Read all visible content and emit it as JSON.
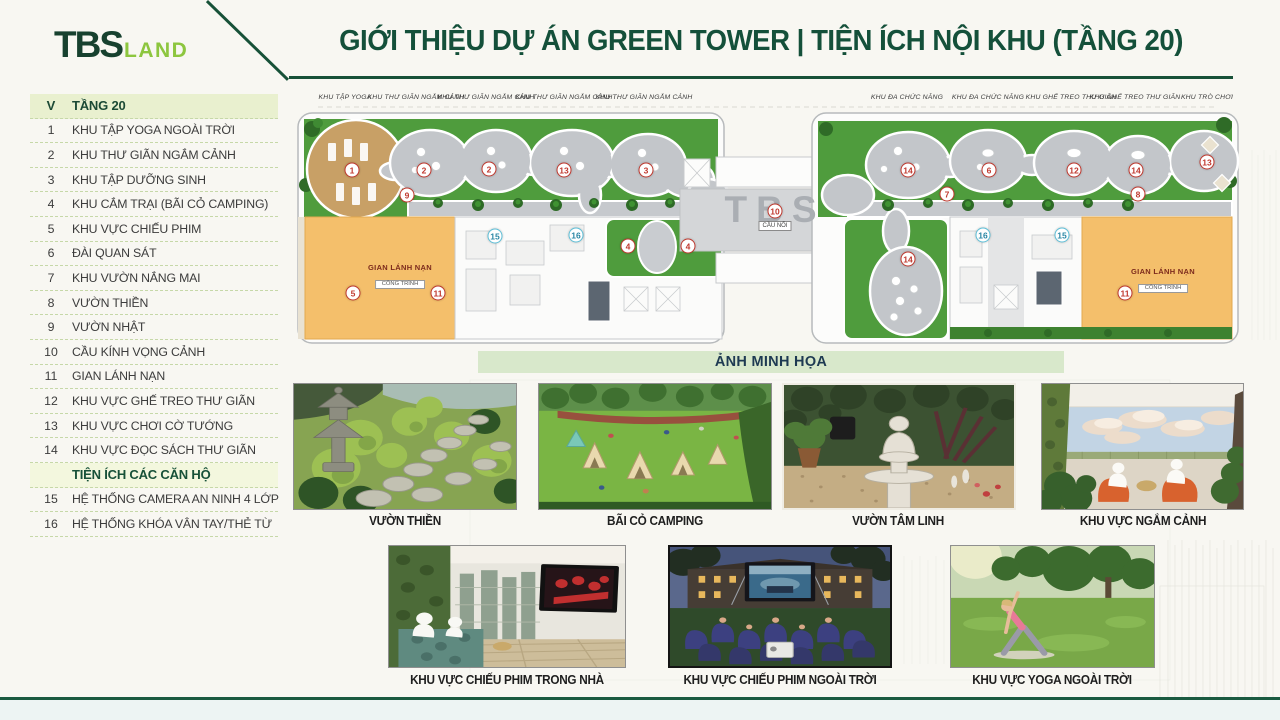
{
  "logo": {
    "tbs": "TBS",
    "land": "LAND"
  },
  "header": {
    "title": "GIỚI THIỆU DỰ ÁN GREEN TOWER | TIỆN ÍCH NỘI KHU (TẦNG 20)"
  },
  "legend": {
    "header": {
      "no": "V",
      "label": "TẦNG 20"
    },
    "rows": [
      {
        "no": "1",
        "label": "KHU TẬP YOGA NGOÀI TRỜI"
      },
      {
        "no": "2",
        "label": "KHU THƯ GIÃN NGẮM CẢNH"
      },
      {
        "no": "3",
        "label": "KHU TẬP DƯỠNG SINH"
      },
      {
        "no": "4",
        "label": "KHU CẮM TRẠI (BÃI CỎ CAMPING)"
      },
      {
        "no": "5",
        "label": "KHU VỰC CHIẾU PHIM"
      },
      {
        "no": "6",
        "label": "ĐÀI QUAN SÁT"
      },
      {
        "no": "7",
        "label": "KHU VƯỜN NẮNG MAI"
      },
      {
        "no": "8",
        "label": "VƯỜN THIỀN"
      },
      {
        "no": "9",
        "label": "VƯỜN NHẬT"
      },
      {
        "no": "10",
        "label": "CẦU KÍNH VỌNG CẢNH"
      },
      {
        "no": "11",
        "label": "GIAN LÁNH NẠN"
      },
      {
        "no": "12",
        "label": "KHU VỰC GHẾ TREO THƯ GIÃN"
      },
      {
        "no": "13",
        "label": "KHU VỰC CHƠI CỜ TƯỚNG"
      },
      {
        "no": "14",
        "label": "KHU VỰC ĐỌC SÁCH THƯ GIÃN"
      }
    ],
    "subheader": "TIỆN ÍCH CÁC CĂN HỘ",
    "rows2": [
      {
        "no": "15",
        "label": "HỆ THỐNG CAMERA AN NINH 4 LỚP"
      },
      {
        "no": "16",
        "label": "HỆ THỐNG KHÓA VÂN TAY/THẺ TỪ"
      }
    ]
  },
  "floorplan": {
    "bridge_text": "TBS",
    "bridge_label": "CẦU NỐI",
    "shelter": {
      "line1": "GIAN LÁNH NẠN",
      "line2": "CÔNG TRÌNH"
    },
    "zone_labels": [
      {
        "label": "KHU TẬP YOGA",
        "x": 57
      },
      {
        "label": "KHU THƯ GIÃN NGẮM CẢNH",
        "x": 128
      },
      {
        "label": "KHU THƯ GIÃN NGẮM CẢNH",
        "x": 198
      },
      {
        "label": "KHU THƯ GIÃN NGẮM CẢNH",
        "x": 276
      },
      {
        "label": "KHU THƯ GIÃN NGẮM CẢNH",
        "x": 356
      },
      {
        "label": "KHU ĐA CHỨC NĂNG",
        "x": 619
      },
      {
        "label": "KHU ĐA CHỨC NĂNG",
        "x": 700
      },
      {
        "label": "KHU GHẾ TREO THƯ GIÃN",
        "x": 783
      },
      {
        "label": "KHU GHẾ TREO THƯ GIÃN",
        "x": 847
      },
      {
        "label": "KHU TRÒ CHƠI",
        "x": 919
      }
    ],
    "markers": [
      {
        "no": "1",
        "x": 64,
        "y": 75,
        "t": "r"
      },
      {
        "no": "2",
        "x": 136,
        "y": 75,
        "t": "r"
      },
      {
        "no": "2",
        "x": 201,
        "y": 74,
        "t": "r"
      },
      {
        "no": "13",
        "x": 276,
        "y": 75,
        "t": "r"
      },
      {
        "no": "3",
        "x": 358,
        "y": 75,
        "t": "r"
      },
      {
        "no": "9",
        "x": 119,
        "y": 100,
        "t": "r"
      },
      {
        "no": "4",
        "x": 340,
        "y": 151,
        "t": "r"
      },
      {
        "no": "4",
        "x": 400,
        "y": 151,
        "t": "r"
      },
      {
        "no": "5",
        "x": 65,
        "y": 198,
        "t": "r"
      },
      {
        "no": "11",
        "x": 150,
        "y": 198,
        "t": "r"
      },
      {
        "no": "10",
        "x": 487,
        "y": 116,
        "t": "r"
      },
      {
        "no": "14",
        "x": 620,
        "y": 75,
        "t": "r"
      },
      {
        "no": "6",
        "x": 701,
        "y": 75,
        "t": "r"
      },
      {
        "no": "12",
        "x": 786,
        "y": 75,
        "t": "r"
      },
      {
        "no": "14",
        "x": 848,
        "y": 75,
        "t": "r"
      },
      {
        "no": "13",
        "x": 919,
        "y": 67,
        "t": "r"
      },
      {
        "no": "7",
        "x": 659,
        "y": 99,
        "t": "r"
      },
      {
        "no": "8",
        "x": 850,
        "y": 99,
        "t": "r"
      },
      {
        "no": "14",
        "x": 620,
        "y": 164,
        "t": "r"
      },
      {
        "no": "11",
        "x": 837,
        "y": 198,
        "t": "r"
      },
      {
        "no": "15",
        "x": 207,
        "y": 141,
        "t": "b"
      },
      {
        "no": "16",
        "x": 288,
        "y": 140,
        "t": "b"
      },
      {
        "no": "16",
        "x": 695,
        "y": 140,
        "t": "b"
      },
      {
        "no": "15",
        "x": 774,
        "y": 140,
        "t": "b"
      }
    ]
  },
  "banner": {
    "label": "ẢNH MINH HỌA"
  },
  "photos": [
    {
      "caption": "VƯỜN THIỀN"
    },
    {
      "caption": "BÃI CỎ CAMPING"
    },
    {
      "caption": "VƯỜN TÂM LINH"
    },
    {
      "caption": "KHU VỰC NGẮM CẢNH"
    },
    {
      "caption": "KHU VỰC CHIẾU PHIM TRONG NHÀ"
    },
    {
      "caption": "KHU VỰC CHIẾU PHIM NGOÀI TRỜI"
    },
    {
      "caption": "KHU VỰC YOGA NGOÀI TRỜI"
    }
  ]
}
